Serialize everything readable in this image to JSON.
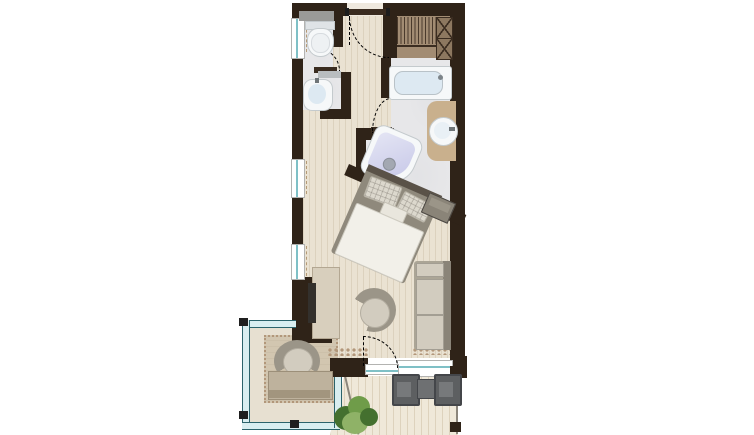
{
  "scene": {
    "type": "architectural-floor-plan",
    "view": "top-down",
    "description": "Color top-view floor plan of a studio hotel suite: entrance with wardrobe, WC, washbasin niche, bathroom with bathtub, corner whirlpool and vanity behind a diagonal wall, bedroom with diagonally placed double bed, living zone with sofa, swivel chair, desk with TV, a glazed loggia with armchair, and a wooden terrace with two chairs, table and a plant."
  },
  "rooms": [
    {
      "id": "entrance-hall"
    },
    {
      "id": "wc"
    },
    {
      "id": "washbasin-niche"
    },
    {
      "id": "wardrobe-area"
    },
    {
      "id": "bathroom"
    },
    {
      "id": "sleeping-area"
    },
    {
      "id": "living-area"
    },
    {
      "id": "glazed-loggia"
    },
    {
      "id": "terrace"
    }
  ],
  "openings": [
    {
      "id": "entry-door",
      "swing": "dashed-arc"
    },
    {
      "id": "wc-door",
      "swing": "dashed-arc"
    },
    {
      "id": "bathroom-door",
      "swing": "dashed-arc"
    },
    {
      "id": "terrace-door",
      "swing": "dashed-arc"
    },
    {
      "id": "window-left-1"
    },
    {
      "id": "window-left-2"
    },
    {
      "id": "window-left-3"
    },
    {
      "id": "window-bottom"
    }
  ],
  "furniture": [
    {
      "id": "toilet"
    },
    {
      "id": "wall-shelf"
    },
    {
      "id": "niche-washbasin"
    },
    {
      "id": "wardrobe-hanger-rail"
    },
    {
      "id": "shelf-cabinet-x"
    },
    {
      "id": "bathtub"
    },
    {
      "id": "vanity-washbasin"
    },
    {
      "id": "whirlpool-tub"
    },
    {
      "id": "double-bed"
    },
    {
      "id": "corner-side-table"
    },
    {
      "id": "lounge-sofa"
    },
    {
      "id": "swivel-armchair"
    },
    {
      "id": "desk-sideboard"
    },
    {
      "id": "tv"
    },
    {
      "id": "loggia-armchair"
    },
    {
      "id": "loggia-bench"
    },
    {
      "id": "outdoor-chair-left"
    },
    {
      "id": "outdoor-table"
    },
    {
      "id": "outdoor-chair-right"
    },
    {
      "id": "potted-plant"
    },
    {
      "id": "glass-balustrade"
    }
  ],
  "colors": {
    "wall": "#2f2318",
    "wall_soft": "#3a2c20",
    "wood": "#eae2d2",
    "wood_line": "#a58f6f33",
    "tile": "#e7e7e9",
    "tile_shade": "#d9dade55",
    "tan": "#a28c73",
    "tan_dark": "#8d7860",
    "rug": "#d2c6b0",
    "loggia_floor": "#e7e0d1",
    "deck": "#efe8d9",
    "deck_line": "#a8906a40",
    "teal": "#7fc0c6",
    "teal_fill": "#d9eef0",
    "teal_dark": "#2c636b",
    "white_fix": "#f6f8f9",
    "fix_border": "#c4cacd",
    "water": "#dde9f2",
    "lavender": "#c7c8e8",
    "lavender_light": "#e4e5f4",
    "vanity": "#c9b08d",
    "bed_frame": "#8f897c",
    "headboard": "#5a5248",
    "duvet": "#f2f0e9",
    "duvet_line": "#cfccc2",
    "pillow": "#dcd8cd",
    "gray_furn": "#9b9588",
    "cushion": "#d2ccbf",
    "sofa_base": "#aba596",
    "sofa_dark": "#8a8478",
    "chair_out": "#5d5f61",
    "chair_out_dark": "#44464a",
    "table_out": "#6e7072",
    "plant1": "#44702f",
    "plant2": "#6f9c49",
    "plant3": "#8fb267",
    "pebble": "#b2977a",
    "arc": "#4a4038",
    "tv": "#33302c",
    "desk": "#d8cfbd",
    "desk_border": "#b3a792",
    "shelf": "#9a9a98",
    "rail_line": "#8b857b"
  }
}
